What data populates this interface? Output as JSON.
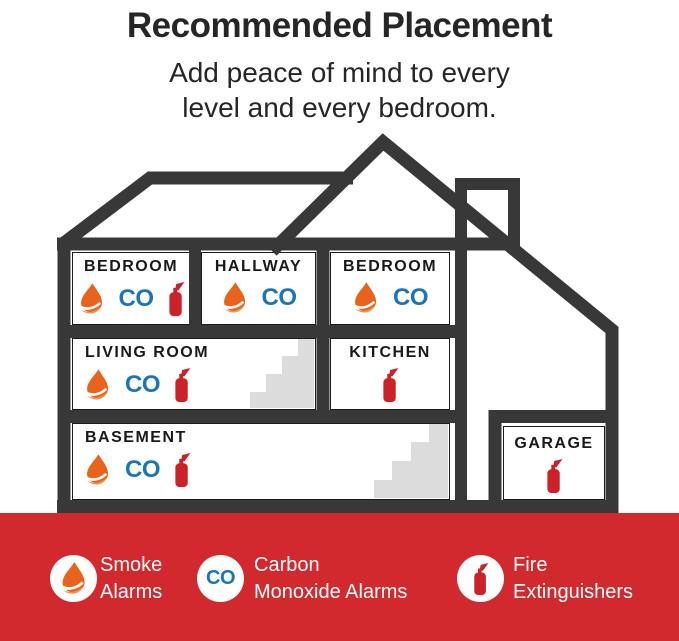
{
  "header": {
    "title": "Recommended Placement",
    "subtitle": [
      "Add peace of mind to every",
      "level and every bedroom."
    ]
  },
  "icons": {
    "co_label": "CO"
  },
  "rooms": {
    "bedroom1": {
      "label": "BEDROOM",
      "icons": [
        "smoke-alarm",
        "co-alarm",
        "fire-extinguisher"
      ]
    },
    "hallway": {
      "label": "HALLWAY",
      "icons": [
        "smoke-alarm",
        "co-alarm"
      ]
    },
    "bedroom2": {
      "label": "BEDROOM",
      "icons": [
        "smoke-alarm",
        "co-alarm"
      ]
    },
    "living": {
      "label": "LIVING ROOM",
      "icons": [
        "smoke-alarm",
        "co-alarm",
        "fire-extinguisher"
      ]
    },
    "kitchen": {
      "label": "KITCHEN",
      "icons": [
        "fire-extinguisher"
      ]
    },
    "basement": {
      "label": "BASEMENT",
      "icons": [
        "smoke-alarm",
        "co-alarm",
        "fire-extinguisher"
      ]
    },
    "garage": {
      "label": "GARAGE",
      "icons": [
        "fire-extinguisher"
      ]
    }
  },
  "legend": {
    "smoke": {
      "line1": "Smoke",
      "line2": "Alarms"
    },
    "co": {
      "line1": "Carbon",
      "line2": "Monoxide Alarms"
    },
    "extinguisher": {
      "line1": "Fire",
      "line2": "Extinguishers"
    }
  },
  "colors": {
    "charcoal": "#383838",
    "red_bar": "#D2292E",
    "icon_red": "#CB2127",
    "co_blue": "#1B75BB",
    "flame_primary": "#E8641C",
    "flame_secondary": "#F0934C",
    "stairs_gray": "#DCDCDC"
  }
}
